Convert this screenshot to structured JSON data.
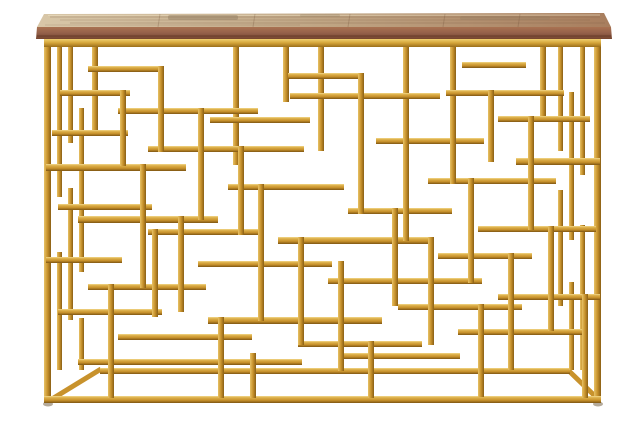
{
  "meta": {
    "description": "Product photo of a rectangular console table: rustic reclaimed-wood plank top on a glam gold geometric openwork metal base, centered on a seamless white background",
    "object": "console-table",
    "background_color": "#ffffff"
  },
  "palette": {
    "gold_light": "#f2d98c",
    "gold_mid_light": "#dcae48",
    "gold_mid": "#c8922c",
    "gold_dark": "#7e5512",
    "gold_v_light": "#e7c266",
    "gold_v_dark": "#8a5f15",
    "rail_light": "#f0cf6f",
    "rail_mid": "#d3a338",
    "rail_dark": "#9a6e1a",
    "wood_top_left": "#d8c7a8",
    "wood_top_mid": "#c2a988",
    "wood_top_right": "#a87e5e",
    "wood_edge_top": "#aa7252",
    "wood_edge_mid": "#94604a",
    "wood_edge_bottom": "#74452f",
    "grain_dark": "#7c5a40",
    "grain_light": "#ecdfc2",
    "patch_gray": "#8f7a5f",
    "foot": "#b4aa9b"
  },
  "figure": {
    "width": 640,
    "height": 427,
    "wood": {
      "surface_points": "44,14 604,13 611,27 37,27",
      "edge_points": "37,27 611,27 612,39 36,39",
      "plank_lines": [
        160,
        255,
        350,
        445,
        520
      ],
      "grain_streaks": [
        [
          50,
          600,
          17,
          0.3
        ],
        [
          60,
          590,
          20,
          0.22
        ],
        [
          70,
          605,
          23,
          0.28
        ],
        [
          45,
          300,
          25,
          0.18
        ]
      ],
      "patches": [
        [
          168,
          15,
          70,
          5,
          0.45
        ],
        [
          460,
          16,
          90,
          4,
          0.3
        ],
        [
          300,
          14,
          40,
          3,
          0.25
        ]
      ],
      "edge_shadow_y": 36
    },
    "frame": {
      "top_rail": [
        44,
        39,
        557,
        8
      ],
      "bars": [
        [
          44,
          47,
          7,
          356
        ],
        [
          594,
          47,
          7,
          356
        ],
        [
          44,
          396,
          557,
          7
        ],
        [
          100,
          368,
          470,
          6
        ],
        [
          57,
          47,
          5,
          150
        ],
        [
          57,
          252,
          5,
          118
        ],
        [
          68,
          47,
          5,
          96
        ],
        [
          68,
          188,
          5,
          132
        ],
        [
          79,
          108,
          5,
          164
        ],
        [
          79,
          318,
          5,
          52
        ],
        [
          580,
          47,
          5,
          128
        ],
        [
          580,
          225,
          5,
          145
        ],
        [
          569,
          92,
          5,
          148
        ],
        [
          569,
          282,
          5,
          88
        ],
        [
          558,
          47,
          5,
          104
        ],
        [
          558,
          190,
          5,
          116
        ],
        [
          92,
          47,
          6,
          86
        ],
        [
          233,
          47,
          6,
          118
        ],
        [
          283,
          47,
          6,
          55
        ],
        [
          318,
          47,
          6,
          104
        ],
        [
          403,
          47,
          6,
          78
        ],
        [
          450,
          47,
          6,
          66
        ],
        [
          540,
          47,
          6,
          72
        ],
        [
          88,
          66,
          72,
          6
        ],
        [
          60,
          90,
          70,
          6
        ],
        [
          118,
          108,
          140,
          6
        ],
        [
          288,
          73,
          70,
          6
        ],
        [
          290,
          93,
          150,
          6
        ],
        [
          462,
          62,
          64,
          6
        ],
        [
          446,
          90,
          118,
          6
        ],
        [
          498,
          116,
          92,
          6
        ],
        [
          52,
          130,
          76,
          6
        ],
        [
          148,
          146,
          156,
          6
        ],
        [
          376,
          138,
          108,
          6
        ],
        [
          46,
          164,
          140,
          7
        ],
        [
          516,
          158,
          84,
          7
        ],
        [
          210,
          117,
          100,
          6
        ],
        [
          228,
          184,
          116,
          6
        ],
        [
          428,
          178,
          128,
          6
        ],
        [
          58,
          204,
          94,
          6
        ],
        [
          78,
          216,
          140,
          7
        ],
        [
          348,
          208,
          104,
          6
        ],
        [
          148,
          229,
          116,
          6
        ],
        [
          278,
          237,
          154,
          7
        ],
        [
          478,
          226,
          118,
          6
        ],
        [
          46,
          257,
          76,
          6
        ],
        [
          198,
          261,
          134,
          6
        ],
        [
          438,
          253,
          94,
          6
        ],
        [
          88,
          284,
          118,
          6
        ],
        [
          328,
          278,
          154,
          6
        ],
        [
          498,
          294,
          102,
          6
        ],
        [
          58,
          309,
          104,
          6
        ],
        [
          208,
          317,
          174,
          7
        ],
        [
          398,
          304,
          124,
          6
        ],
        [
          118,
          334,
          134,
          6
        ],
        [
          298,
          341,
          124,
          6
        ],
        [
          458,
          329,
          124,
          6
        ],
        [
          78,
          359,
          224,
          6
        ],
        [
          340,
          353,
          120,
          6
        ],
        [
          120,
          90,
          6,
          76
        ],
        [
          158,
          66,
          6,
          86
        ],
        [
          198,
          108,
          6,
          112
        ],
        [
          238,
          146,
          6,
          89
        ],
        [
          358,
          73,
          6,
          141
        ],
        [
          403,
          125,
          6,
          116
        ],
        [
          450,
          113,
          6,
          71
        ],
        [
          488,
          90,
          6,
          72
        ],
        [
          528,
          116,
          6,
          114
        ],
        [
          140,
          164,
          6,
          124
        ],
        [
          178,
          216,
          6,
          96
        ],
        [
          258,
          184,
          6,
          137
        ],
        [
          298,
          237,
          6,
          108
        ],
        [
          338,
          261,
          6,
          110
        ],
        [
          392,
          208,
          6,
          98
        ],
        [
          428,
          237,
          6,
          108
        ],
        [
          468,
          178,
          6,
          105
        ],
        [
          508,
          253,
          6,
          117
        ],
        [
          548,
          226,
          6,
          105
        ],
        [
          582,
          294,
          6,
          104
        ],
        [
          108,
          284,
          6,
          114
        ],
        [
          218,
          317,
          6,
          81
        ],
        [
          368,
          341,
          6,
          57
        ],
        [
          478,
          304,
          6,
          93
        ],
        [
          152,
          229,
          6,
          88
        ],
        [
          250,
          353,
          6,
          45
        ]
      ],
      "diagonals": [
        [
          101,
          369,
          52,
          399
        ],
        [
          569,
          371,
          598,
          399
        ]
      ],
      "feet": [
        [
          48,
          404
        ],
        [
          598,
          404
        ]
      ]
    }
  }
}
